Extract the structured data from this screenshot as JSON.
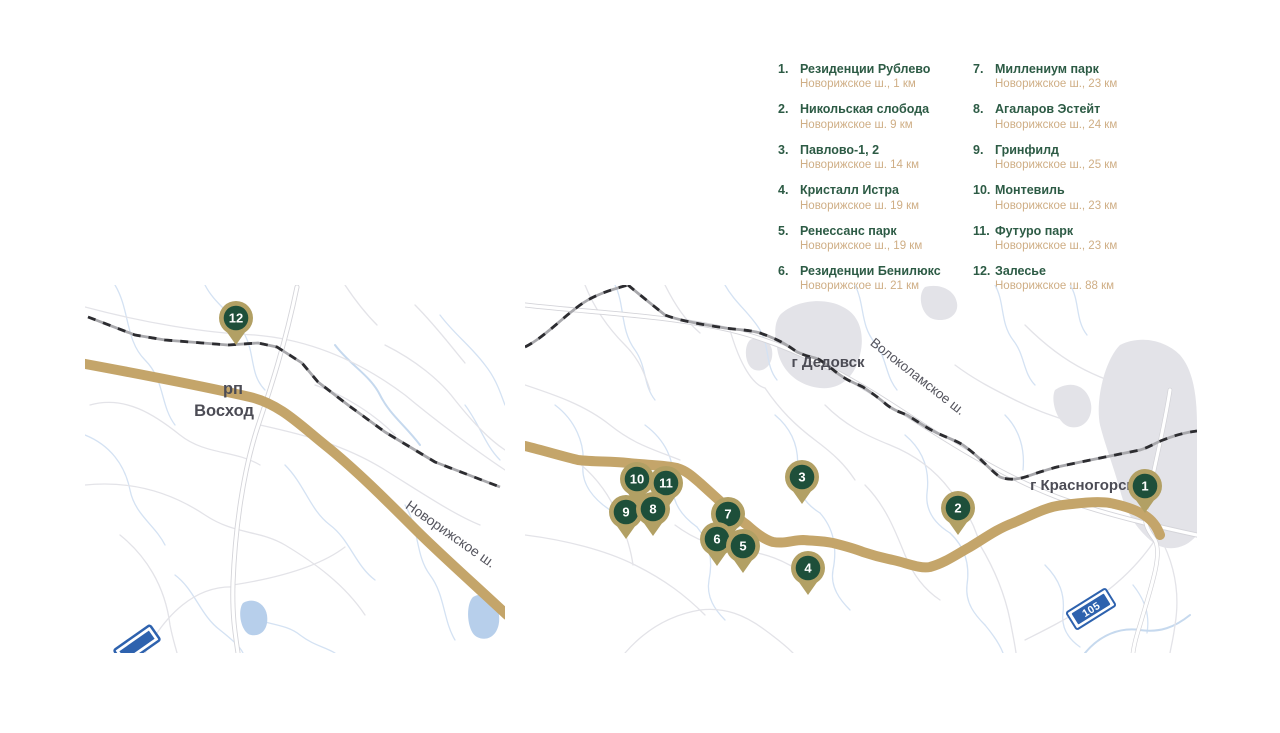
{
  "colors": {
    "legend_green": "#2d5b45",
    "legend_tan": "#cfae85",
    "marker_green": "#1e4f3a",
    "marker_ring_tan": "#b2a064",
    "highway_tan": "#c4a56a",
    "badge_blue": "#2e62ae"
  },
  "legend": {
    "items": [
      {
        "num": "1.",
        "name": "Резиденции Рублево",
        "distance": "Новорижское ш., 1 км"
      },
      {
        "num": "2.",
        "name": "Никольская слобода",
        "distance": "Новорижское ш. 9 км"
      },
      {
        "num": "3.",
        "name": "Павлово-1, 2",
        "distance": "Новорижское ш. 14 км"
      },
      {
        "num": "4.",
        "name": "Кристалл Истра",
        "distance": "Новорижское ш. 19 км"
      },
      {
        "num": "5.",
        "name": "Ренессанс парк",
        "distance": "Новорижское ш., 19 км"
      },
      {
        "num": "6.",
        "name": "Резиденции Бенилюкс",
        "distance": "Новорижское ш. 21 км"
      },
      {
        "num": "7.",
        "name": "Миллениум парк",
        "distance": "Новорижское ш., 23 км"
      },
      {
        "num": "8.",
        "name": "Агаларов Эстейт",
        "distance": "Новорижское ш., 24 км"
      },
      {
        "num": "9.",
        "name": "Гринфилд",
        "distance": "Новорижское ш., 25 км"
      },
      {
        "num": "10.",
        "name": "Монтевиль",
        "distance": "Новорижское ш., 23 км"
      },
      {
        "num": "11.",
        "name": "Футуро парк",
        "distance": "Новорижское ш., 23 км"
      },
      {
        "num": "12.",
        "name": "Залесье",
        "distance": "Новорижское ш. 88 км"
      }
    ]
  },
  "maps": {
    "left": {
      "settlement_type": "рп",
      "settlement_name": "Восход",
      "highway_label": "Новорижское ш."
    },
    "right": {
      "city_dedovsk": "г Дедовск",
      "city_krasnogorsk": "г Красногорск",
      "highway_label": "Волоколамское ш.",
      "road_badge": "105"
    }
  },
  "markers": {
    "left": [
      {
        "id": "12",
        "x": 151,
        "y": 33
      }
    ],
    "right": [
      {
        "id": "10",
        "x": 112,
        "y": 194
      },
      {
        "id": "11",
        "x": 141,
        "y": 198
      },
      {
        "id": "9",
        "x": 101,
        "y": 227
      },
      {
        "id": "8",
        "x": 128,
        "y": 224
      },
      {
        "id": "7",
        "x": 203,
        "y": 229
      },
      {
        "id": "6",
        "x": 192,
        "y": 254
      },
      {
        "id": "5",
        "x": 218,
        "y": 261
      },
      {
        "id": "3",
        "x": 277,
        "y": 192
      },
      {
        "id": "4",
        "x": 283,
        "y": 283
      },
      {
        "id": "2",
        "x": 433,
        "y": 223
      },
      {
        "id": "1",
        "x": 620,
        "y": 201
      }
    ]
  }
}
